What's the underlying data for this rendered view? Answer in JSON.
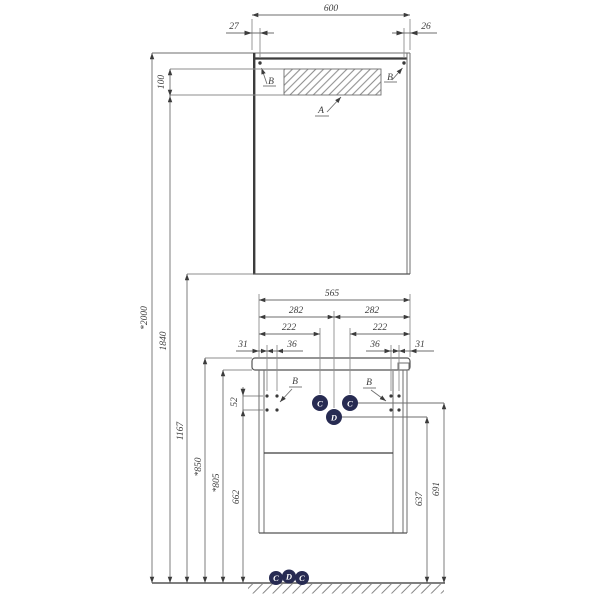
{
  "colors": {
    "bg": "#ffffff",
    "line": "#6e6e6e",
    "ext": "#8d8d8d",
    "accent": "#3c3c3c",
    "text": "#3c3c3c",
    "callout": "#272b52",
    "callout_text": "#ffffff"
  },
  "mirror_cabinet": {
    "width": "600",
    "hole_offset_left": "27",
    "hole_offset_right": "26",
    "light_panel_height": "100",
    "label_light_panel": "A",
    "label_hole_left": "B",
    "label_hole_right": "B"
  },
  "heights": {
    "overall": "*2000",
    "light_bottom": "1840",
    "cabinet_bottom": "1167",
    "countertop_top": "*850",
    "countertop_underside": "*805",
    "holes_bottom": "662",
    "holes_gap": "52",
    "drain": "637",
    "water_supply": "691"
  },
  "vanity": {
    "width": "565",
    "center_left": "282",
    "center_right": "282",
    "supply_offset_left": "222",
    "supply_offset_right": "222",
    "edge_to_hole_left": "31",
    "hole_gap_left": "36",
    "hole_gap_right": "36",
    "edge_to_hole_right": "31",
    "label_hole_left": "B",
    "label_hole_right": "B"
  },
  "callouts": {
    "supply_left": "C",
    "supply_right": "C",
    "drain": "D",
    "floor": [
      "C",
      "D",
      "C"
    ]
  }
}
